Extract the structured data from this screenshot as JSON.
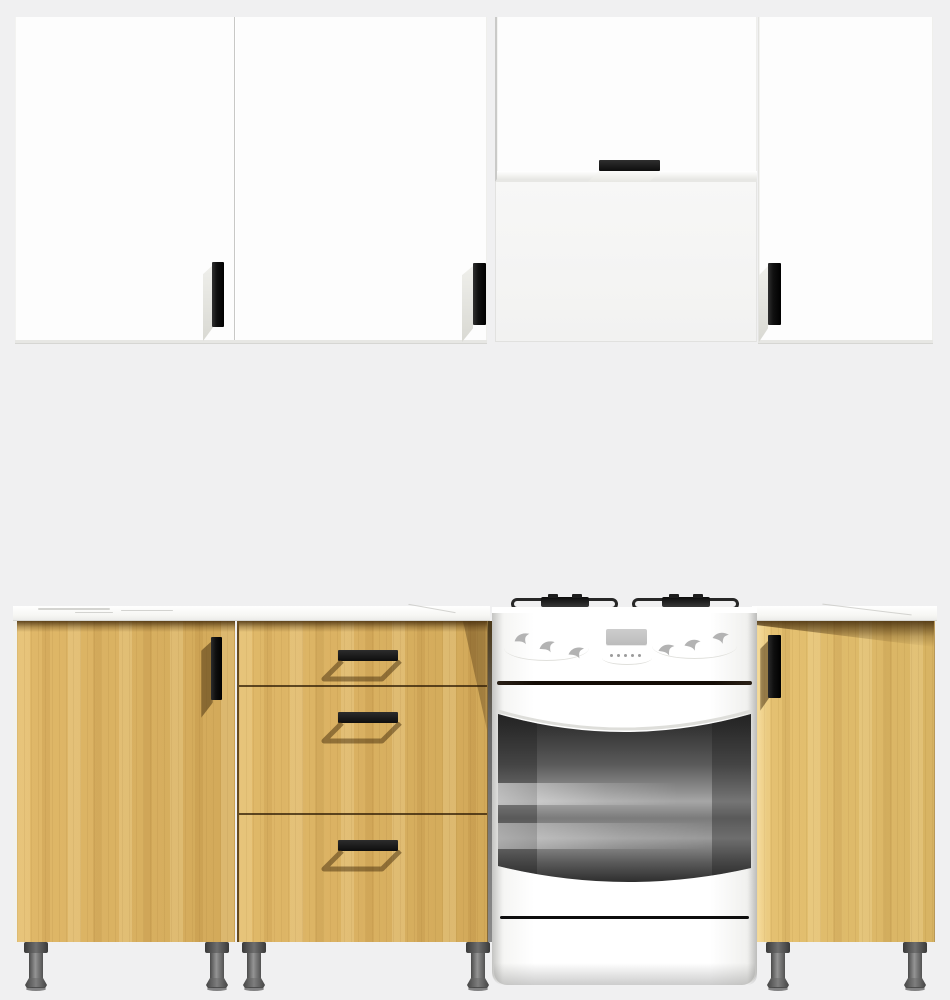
{
  "scene": {
    "type": "kitchen-set-3d-render",
    "background": "#f0f0f1",
    "palette": {
      "cabinet_white": "#fdfdfd",
      "wood_light": "#ddb25e",
      "wood_lighter": "#e3bd68",
      "handle_black": "#161616",
      "countertop": "#fbfbf8",
      "countertop_vein": "#c9c9c5",
      "leg_gray": "#5a5a5a",
      "stove_white": "#fcfcfc",
      "oven_glass_dark": "#2e2e2e",
      "oven_glass_metallic": "#9c9c9c"
    },
    "upper_row": {
      "left_cabinet": {
        "label": "wall cabinet with two doors",
        "doors": 2,
        "handle_style": "vertical-bar"
      },
      "middle_cabinet": {
        "label": "flip-up wall cabinet above cooker",
        "doors": 1,
        "handle_style": "horizontal-bar"
      },
      "right_cabinet": {
        "label": "wall cabinet with one door",
        "doors": 1,
        "handle_style": "vertical-bar"
      }
    },
    "base_row": {
      "left_cabinet": {
        "label": "base cabinet with one door",
        "doors": 1
      },
      "drawer_unit": {
        "label": "base cabinet with three drawers",
        "drawers": 3
      },
      "cooker": {
        "label": "freestanding cooker with oven",
        "burner_grates": 2,
        "control_knobs": 6,
        "display_buttons": 5,
        "has_display": true,
        "has_oven_window": true,
        "has_storage_drawer": true
      },
      "right_cabinet": {
        "label": "base cabinet with one door",
        "doors": 1
      }
    },
    "countertop_sections": 2,
    "legs": {
      "count": 6
    }
  }
}
